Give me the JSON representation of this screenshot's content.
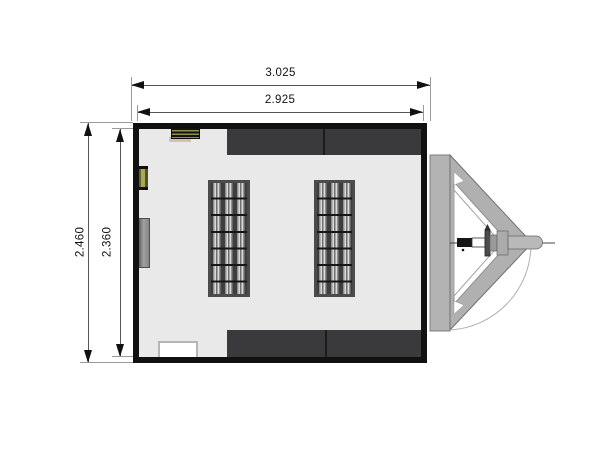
{
  "drawing": {
    "type": "trailer-floorplan-top-view",
    "dimensions": {
      "top_outer": "3.025",
      "top_inner": "2.925",
      "left_outer": "2.460",
      "left_inner": "2.360"
    },
    "colors": {
      "wall": "#111111",
      "floor": "#e9e9e9",
      "band": "#3a3a3c",
      "panel_frame": "#4b4b4b",
      "olive": "#8f8f4e",
      "metal": "#b3b3b3",
      "dim_text": "#111111"
    }
  }
}
